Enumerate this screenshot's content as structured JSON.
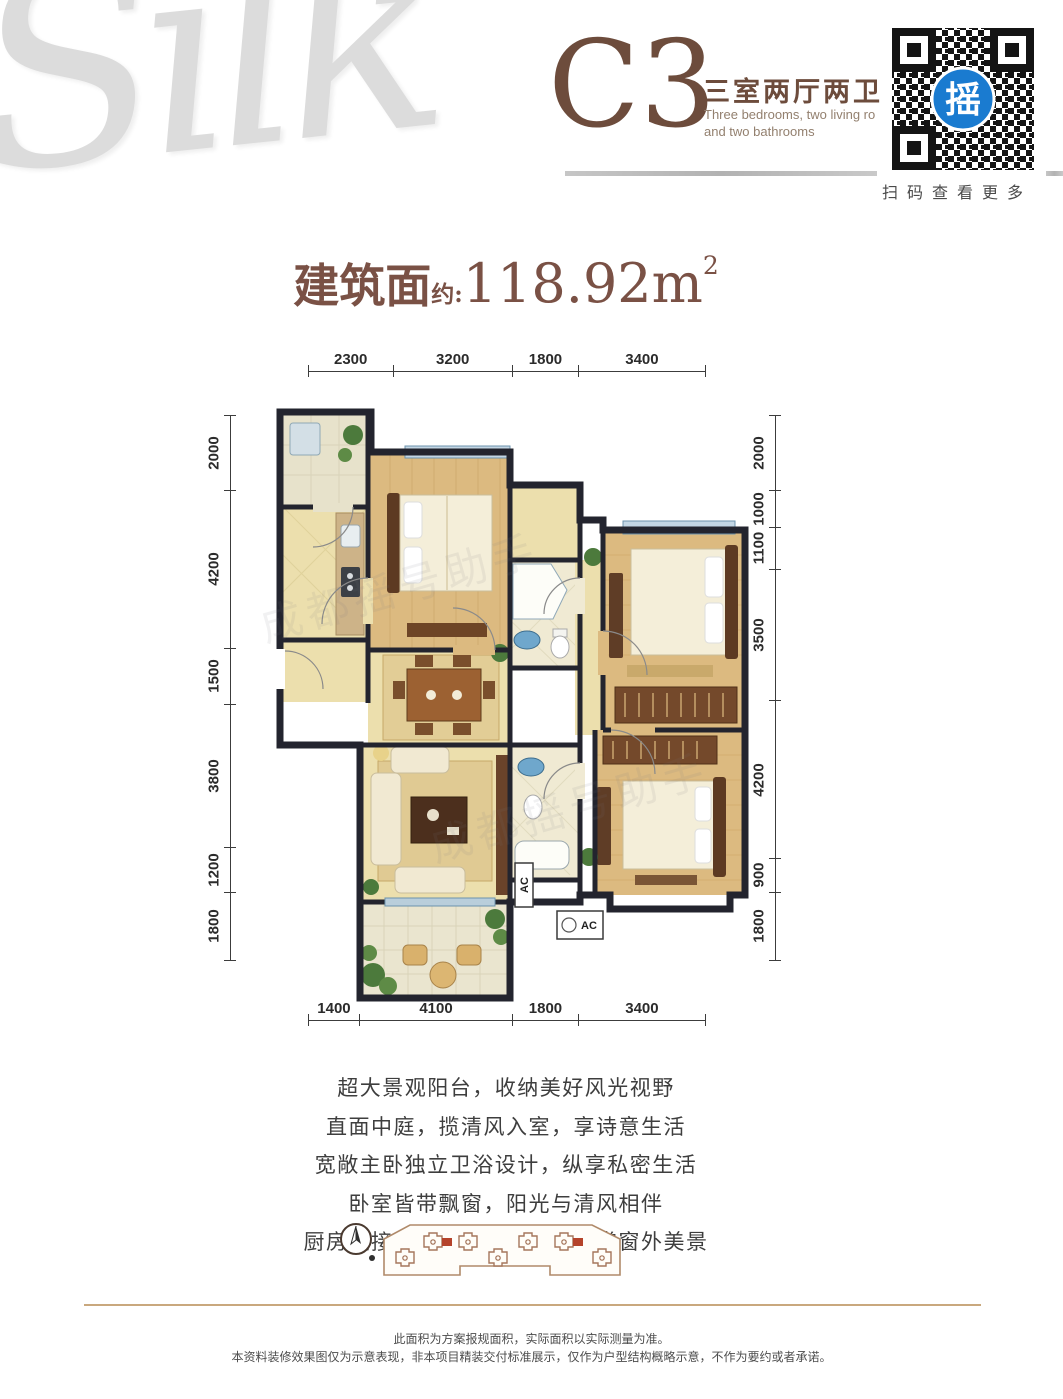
{
  "logo": {
    "text": "Silk"
  },
  "header": {
    "unit_code": "C3",
    "type_cn": "三室两厅两卫",
    "type_en_line1": "Three bedrooms, two living ro",
    "type_en_line2": "and two bathrooms"
  },
  "qr": {
    "glyph": "摇",
    "caption": "扫码查看更多"
  },
  "area": {
    "label": "建筑面",
    "approx": "约:",
    "value": "118.92",
    "unit": "m",
    "sup": "2"
  },
  "dims": {
    "top": [
      "2300",
      "3200",
      "1800",
      "3400"
    ],
    "bottom": [
      "1400",
      "4100",
      "1800",
      "3400"
    ],
    "left": [
      "2000",
      "4200",
      "1500",
      "3800",
      "1200",
      "1800"
    ],
    "right": [
      "2000",
      "1000",
      "1100",
      "3500",
      "4200",
      "900",
      "1800"
    ]
  },
  "plan": {
    "ac_label": "AC",
    "watermark": "成都摇号助手"
  },
  "features": {
    "lines": [
      "超大景观阳台，收纳美好风光视野",
      "直面中庭，揽清风入室，享诗意生活",
      "宽敞主卧独立卫浴设计，纵享私密生活",
      "卧室皆带飘窗，阳光与清风相伴",
      "厨房连接生活阳台，烹饪之余赏窗外美景"
    ]
  },
  "footer": {
    "line1": "此面积为方案报规面积，实际面积以实际测量为准。",
    "line2": "本资料装修效果图仅为示意表现，非本项目精装交付标准展示，仅作为户型结构概略示意，不作为要约或者承诺。"
  },
  "colors": {
    "accent": "#6d4c3c",
    "qr_blue": "#1a7bd0",
    "highlight_red": "#b5432b",
    "rule_tan": "#c9a87e"
  }
}
